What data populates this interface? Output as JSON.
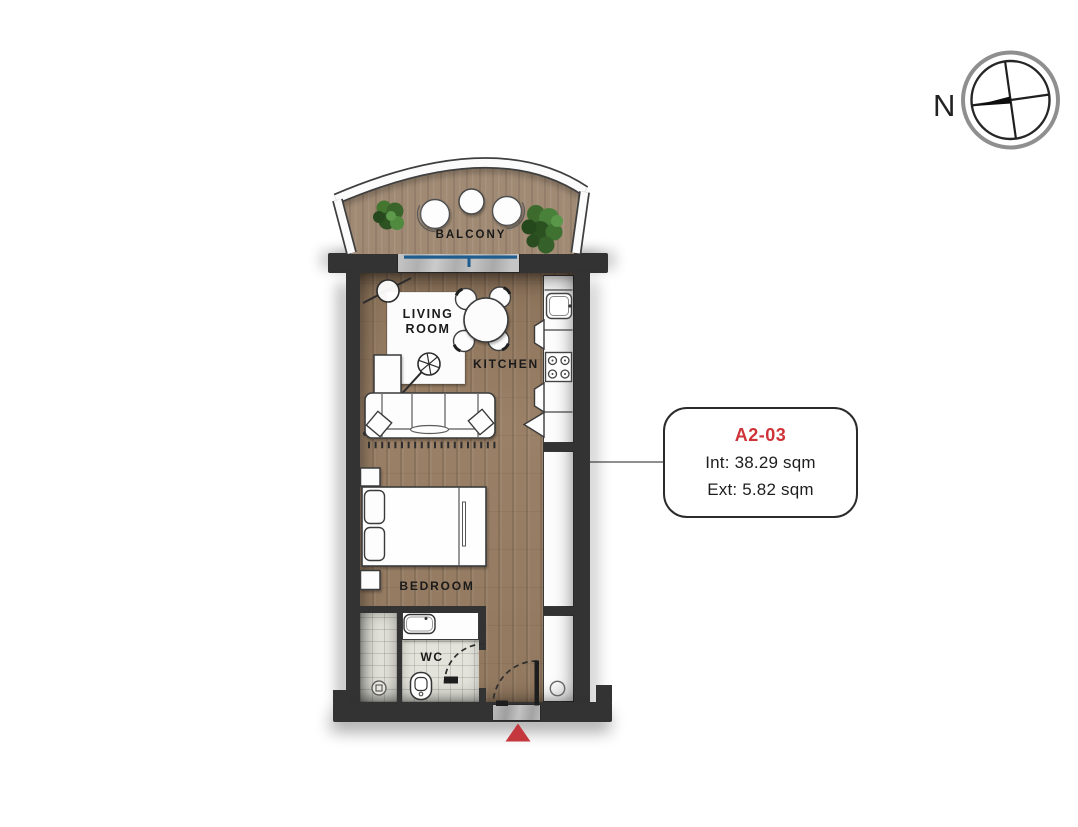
{
  "compass": {
    "north_label": "N"
  },
  "floorplan": {
    "labels": {
      "balcony": "BALCONY",
      "living_room": "LIVING ROOM",
      "kitchen": "KITCHEN",
      "bedroom": "BEDROOM",
      "wc": "WC"
    }
  },
  "unit_card": {
    "unit_id": "A2-03",
    "interior_area": "Int: 38.29 sqm",
    "exterior_area": "Ext: 5.82 sqm"
  },
  "colors": {
    "wall": "#333333",
    "wood_floor": "#9c8268",
    "balcony_wood": "#a08a74",
    "tile": "#e3e3db",
    "accent_red": "#ce3338",
    "window_blue": "#1f5d8f",
    "entrance_arrow_red": "#c4373d"
  }
}
